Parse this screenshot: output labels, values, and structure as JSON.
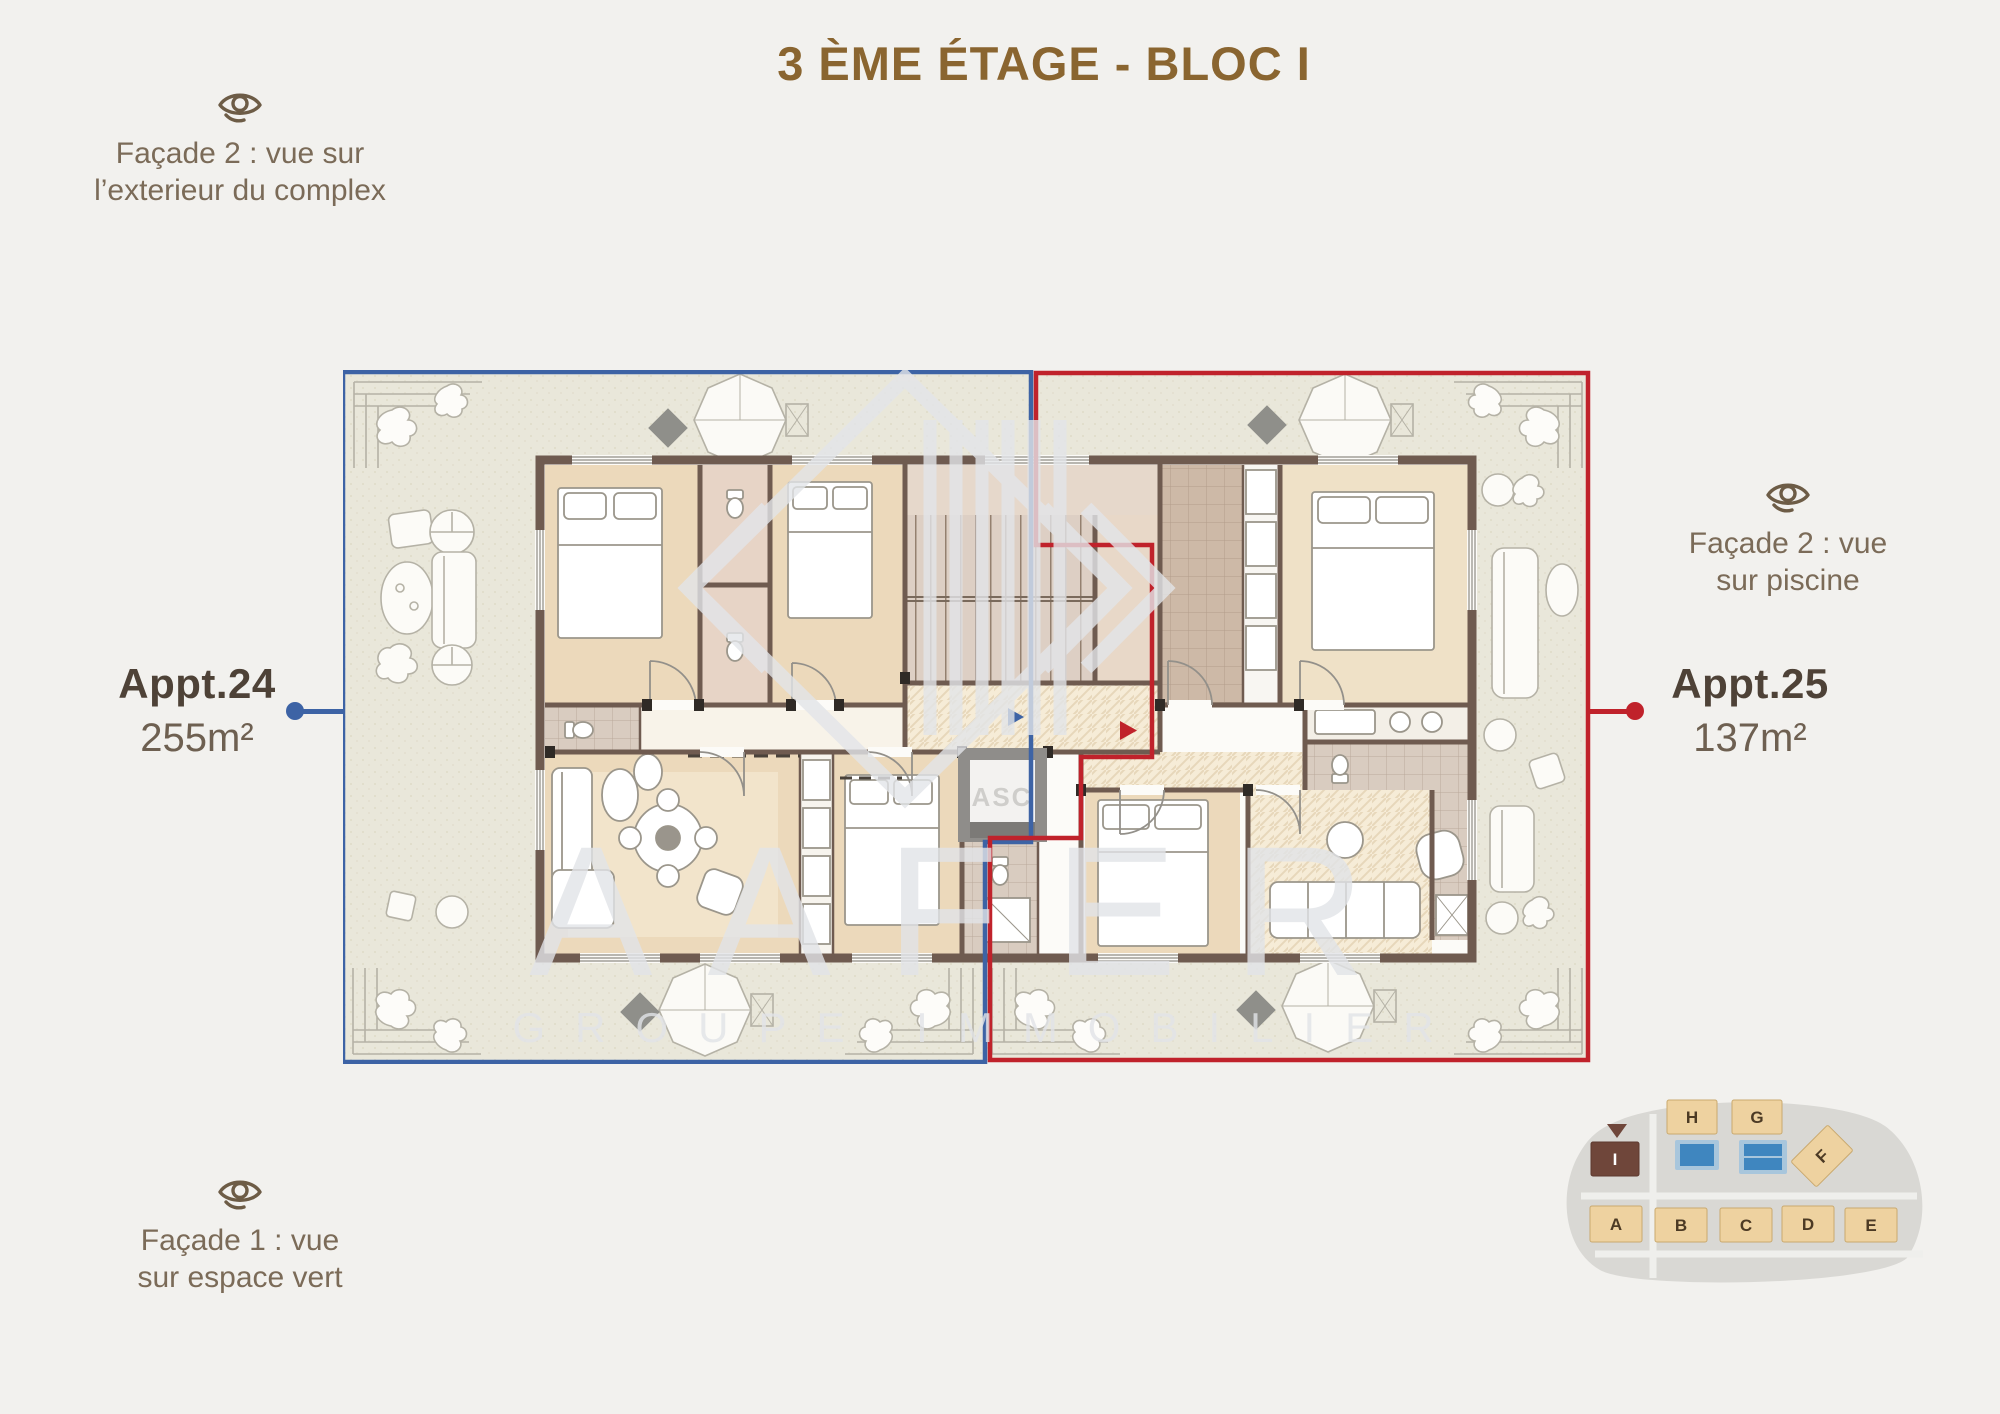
{
  "title": "3 ÈME ÉTAGE - BLOC I",
  "facade_labels": {
    "top_left": {
      "line1": "Façade 2 : vue sur",
      "line2": "l’exterieur du complex"
    },
    "right": {
      "line1": "Façade 2 : vue",
      "line2": "sur piscine"
    },
    "bottom_left": {
      "line1": "Façade 1 : vue",
      "line2": "sur espace vert"
    }
  },
  "apartments": {
    "appt24": {
      "name": "Appt.24",
      "area": "255m²",
      "accent_color": "#3d63a5"
    },
    "appt25": {
      "name": "Appt.25",
      "area": "137m²",
      "accent_color": "#c0222b"
    }
  },
  "plan": {
    "elevator_label": "ASC"
  },
  "watermark": {
    "brand": "AAFER",
    "tagline": "GROUPE IMMOBILIER"
  },
  "site_map": {
    "highlighted_block": "I",
    "blocks": [
      "A",
      "B",
      "C",
      "D",
      "E",
      "F",
      "G",
      "H",
      "I"
    ]
  },
  "colors": {
    "title_brown": "#8a6530",
    "label_text": "#7b6b58",
    "eye_icon": "#6d5c46",
    "appt24_blue": "#3d63a5",
    "appt25_red": "#c0222b",
    "walls": "#6f5b50",
    "room_beige": "#ecd9bb",
    "terrace": "#e9e7da",
    "site_block_tan": "#eed2a0",
    "site_block_brown": "#6f463a",
    "pool_blue": "#3f86bf"
  }
}
